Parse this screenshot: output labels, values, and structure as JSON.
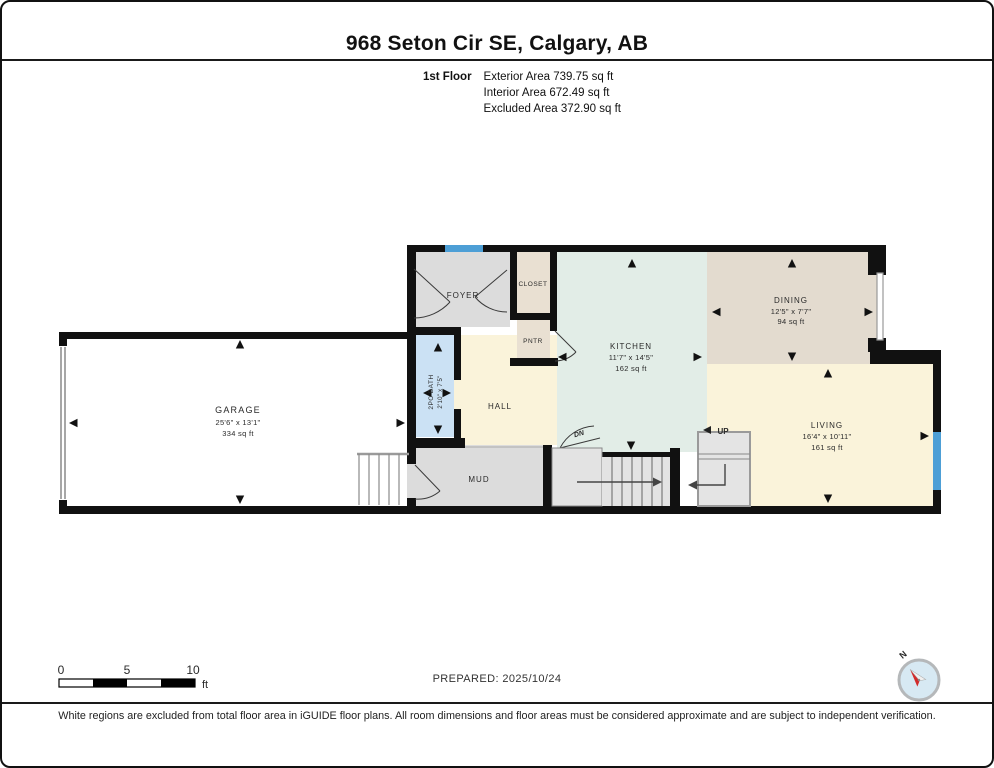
{
  "header": {
    "title": "968 Seton Cir SE, Calgary, AB",
    "floor_label": "1st Floor",
    "area_lines": [
      "Exterior Area 739.75 sq ft",
      "Interior Area 672.49 sq ft",
      "Excluded Area 372.90 sq ft"
    ]
  },
  "floorplan": {
    "rooms": {
      "garage": {
        "name": "GARAGE",
        "dims": "25'6\" x 13'1\"",
        "area": "334 sq ft"
      },
      "foyer": {
        "name": "FOYER"
      },
      "closet": {
        "name": "CLOSET"
      },
      "pantry": {
        "name": "PNTR"
      },
      "hall": {
        "name": "HALL"
      },
      "bath": {
        "name": "2PC BATH",
        "dims": "2'10\" x 7'5\""
      },
      "mud": {
        "name": "MUD"
      },
      "kitchen": {
        "name": "KITCHEN",
        "dims": "11'7\" x 14'5\"",
        "area": "162 sq ft"
      },
      "dining": {
        "name": "DINING",
        "dims": "12'5\" x 7'7\"",
        "area": "94 sq ft"
      },
      "living": {
        "name": "LIVING",
        "dims": "16'4\" x 10'11\"",
        "area": "161 sq ft"
      }
    },
    "stairs": {
      "down_label": "DN",
      "up_label": "UP"
    }
  },
  "scale_bar": {
    "ticks": [
      "0",
      "5",
      "10"
    ],
    "unit": "ft"
  },
  "compass": {
    "north_label": "N"
  },
  "footer": {
    "prepared": "PREPARED: 2025/10/24",
    "disclaimer": "White regions are excluded from total floor area in iGUIDE floor plans. All room dimensions and floor areas must be considered approximate and are subject to independent verification."
  },
  "colors": {
    "wall": "#111111",
    "window_blue": "#4d9fd6",
    "bath_blue": "#cbe1f4",
    "kitchen_mint": "#e2ede7",
    "dining_tan": "#e3dbcf",
    "living_cream": "#faf3da",
    "foyer_gray": "#dcdcdc",
    "closet_tan": "#e9e0d2",
    "stairs_gray": "#e3e3e3",
    "compass_red": "#d22b2b"
  }
}
